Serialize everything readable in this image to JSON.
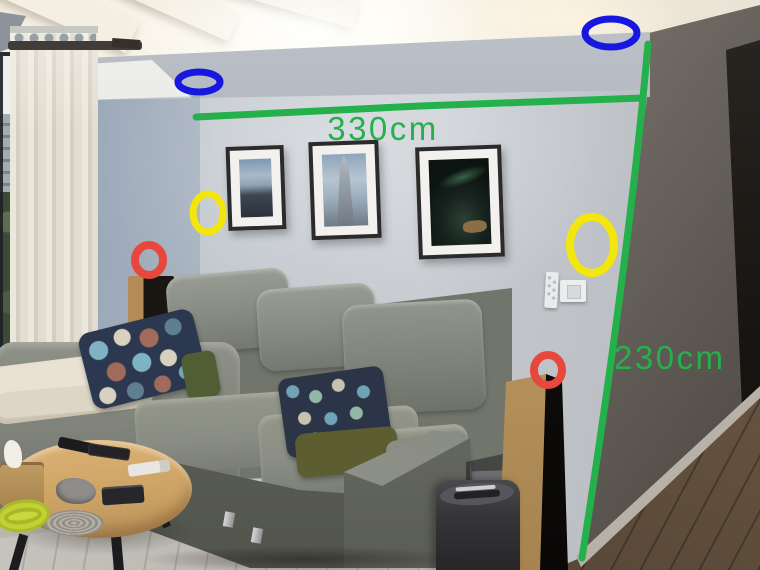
{
  "image": {
    "kind": "annotated room photo",
    "scene_objects": [
      "ceiling cove lighting",
      "curtain",
      "window",
      "three framed pictures",
      "gray sectional sofa",
      "patterned pillows",
      "round wooden coffee table",
      "remote controls",
      "tissue box",
      "floor speakers",
      "paper shredder",
      "light switch",
      "wood floor"
    ]
  },
  "palette": {
    "annotation_green": "#24b14c",
    "annotation_blue": "#1618e0",
    "annotation_yellow": "#f2e60c",
    "annotation_red": "#e8473e",
    "wall_gray": "#c3c8cd",
    "sofa_gray": "#868a80",
    "wood": "#c79e63"
  },
  "annotations": {
    "width_label": "330cm",
    "height_label": "230cm",
    "shapes": [
      {
        "type": "path",
        "name": "green-width-line",
        "color": "#24b14c",
        "sw": 7,
        "d": "M196,117 L420,106 L643,98"
      },
      {
        "type": "path",
        "name": "green-height-line",
        "color": "#24b14c",
        "sw": 7,
        "d": "M648,44 C636,180 616,340 582,558"
      },
      {
        "type": "ellipse",
        "name": "blue-ellipse-ceiling-left",
        "color": "#1618e0",
        "cx": 199,
        "cy": 82,
        "rx": 21,
        "ry": 10,
        "sw": 7
      },
      {
        "type": "ellipse",
        "name": "blue-ellipse-ceiling-right",
        "color": "#1618e0",
        "cx": 611,
        "cy": 33,
        "rx": 26,
        "ry": 14,
        "sw": 7
      },
      {
        "type": "ellipse",
        "name": "yellow-ellipse-wall-left",
        "color": "#f2e60c",
        "cx": 208,
        "cy": 213,
        "rx": 15,
        "ry": 19,
        "sw": 7
      },
      {
        "type": "ellipse",
        "name": "yellow-ellipse-wall-right",
        "color": "#f2e60c",
        "cx": 592,
        "cy": 245,
        "rx": 22,
        "ry": 28,
        "sw": 8
      },
      {
        "type": "ellipse",
        "name": "red-circle-left-speaker",
        "color": "#e8473e",
        "cx": 149,
        "cy": 260,
        "rx": 14,
        "ry": 15,
        "sw": 8
      },
      {
        "type": "ellipse",
        "name": "red-circle-right-speaker",
        "color": "#e8473e",
        "cx": 548,
        "cy": 370,
        "rx": 14,
        "ry": 15,
        "sw": 8
      }
    ],
    "labels": [
      {
        "name": "width-measurement-label",
        "x": 383,
        "y": 140,
        "anchor": "middle"
      },
      {
        "name": "height-measurement-label",
        "x": 614,
        "y": 369,
        "anchor": "start"
      }
    ]
  }
}
